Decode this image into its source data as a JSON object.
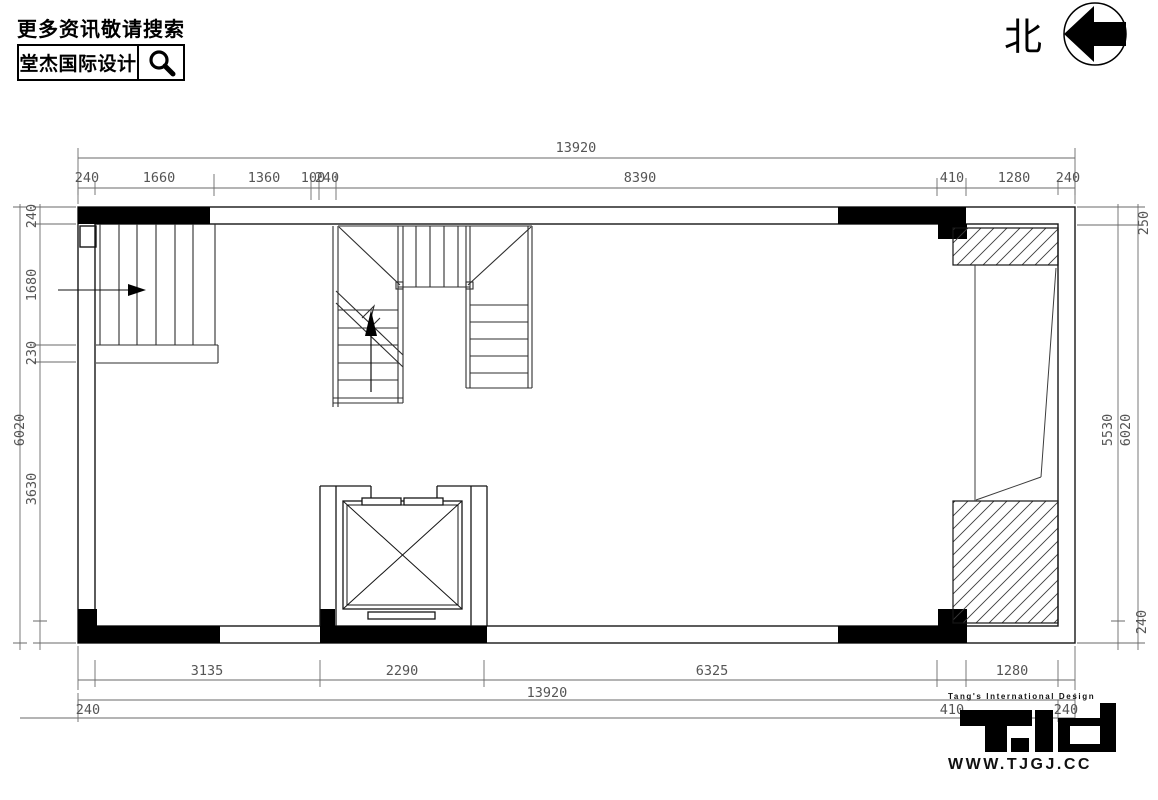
{
  "header": {
    "tagline": "更多资讯敬请搜索",
    "brand": "堂杰国际设计"
  },
  "compass": {
    "label": "北"
  },
  "plan": {
    "dimensions": {
      "top": {
        "overall": "13920",
        "segments": [
          "240",
          "1660",
          "1360",
          "100",
          "240",
          "8390",
          "410",
          "1280",
          "240"
        ]
      },
      "bottom": {
        "overall": "13920",
        "segments": [
          "3135",
          "2290",
          "6325",
          "1280"
        ],
        "edge": [
          "240",
          "410",
          "240"
        ]
      },
      "left": {
        "overall": "6020",
        "segments": [
          "240",
          "1680",
          "230",
          "3630"
        ]
      },
      "right": {
        "overall": "6020",
        "segments": [
          "250",
          "5530",
          "240"
        ]
      }
    },
    "features": [
      "stair-upper-left",
      "u-stair-core",
      "elevator-shaft",
      "hatched-void-top",
      "hatched-void-bottom"
    ]
  },
  "footer": {
    "tagline": "Tang's International Design",
    "website": "WWW.TJGJ.CC"
  },
  "colors": {
    "ink": "#111111",
    "dim_line": "#6a6a6a",
    "dim_text": "#555555"
  }
}
